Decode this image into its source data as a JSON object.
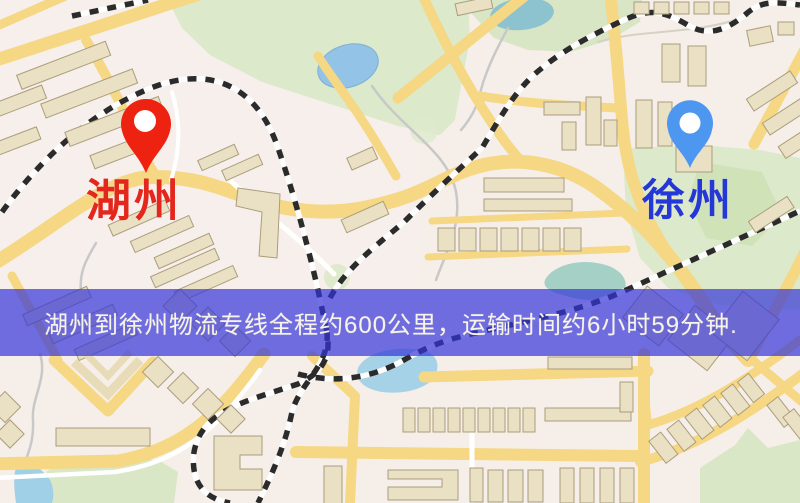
{
  "origin": {
    "name": "湖州",
    "label_color": "#e3271c",
    "pin_color": "#ee2211"
  },
  "destination": {
    "name": "徐州",
    "label_color": "#2538d6",
    "pin_color": "#4e97f0"
  },
  "banner": {
    "text": "湖州到徐州物流专线全程约600公里，运输时间约6小时59分钟.",
    "background_color": "rgba(52,52,216,0.70)",
    "text_color": "#f7f3e6"
  },
  "map_colors": {
    "background": "#f6efe9",
    "road_yellow": "#f5d784",
    "park_green": "#dce9ca",
    "water_blue": "#a2cfe4",
    "building_fill": "#eae0c3",
    "railway_dark": "#2b2b2b"
  }
}
